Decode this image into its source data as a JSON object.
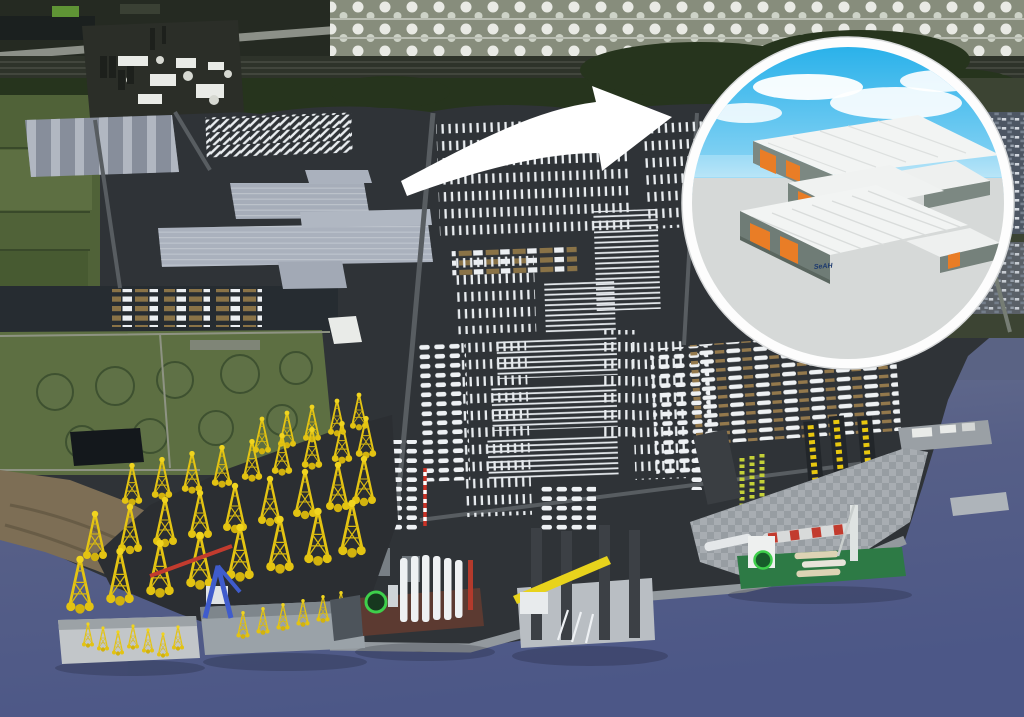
{
  "scene": {
    "inset": {
      "building_logo": "SeAH"
    },
    "palette": {
      "water": "#5a6384",
      "water_deep": "#4d5889",
      "asphalt": "#2f3337",
      "asphalt_dark": "#26292d",
      "grass": "#506238",
      "grass_light": "#5d6f42",
      "trees": "#26341d",
      "mudflat": "#7d6e55",
      "tankfarm": "#878d7c",
      "quay": "#93999e",
      "jacket_yellow": "#e5c513",
      "anchor_yellow": "#e8c70f",
      "lime_rows": "#c4d038",
      "crate_brown": "#8a7347",
      "blade_white": "#eef1f4",
      "factory_gray": "#a6adb9",
      "warehouse_gray": "#878e9b",
      "carpark": "#4d5663",
      "arrow": "#ffffff",
      "ring": "#fdfdfd",
      "inset_sky_top": "#29b1ea",
      "inset_sky_bottom": "#bfe7f8",
      "inset_ground": "#d6d9d8",
      "inset_roof": "#f2f4f3",
      "inset_wall": "#6f7c76",
      "door_orange": "#e97d26",
      "hull_green": "#2d7a45",
      "hull_brown": "#5c3a31",
      "crane_blue": "#3f5ccc",
      "boom_yellow": "#e8d31c",
      "helipad_green": "#3ecf4b"
    }
  }
}
